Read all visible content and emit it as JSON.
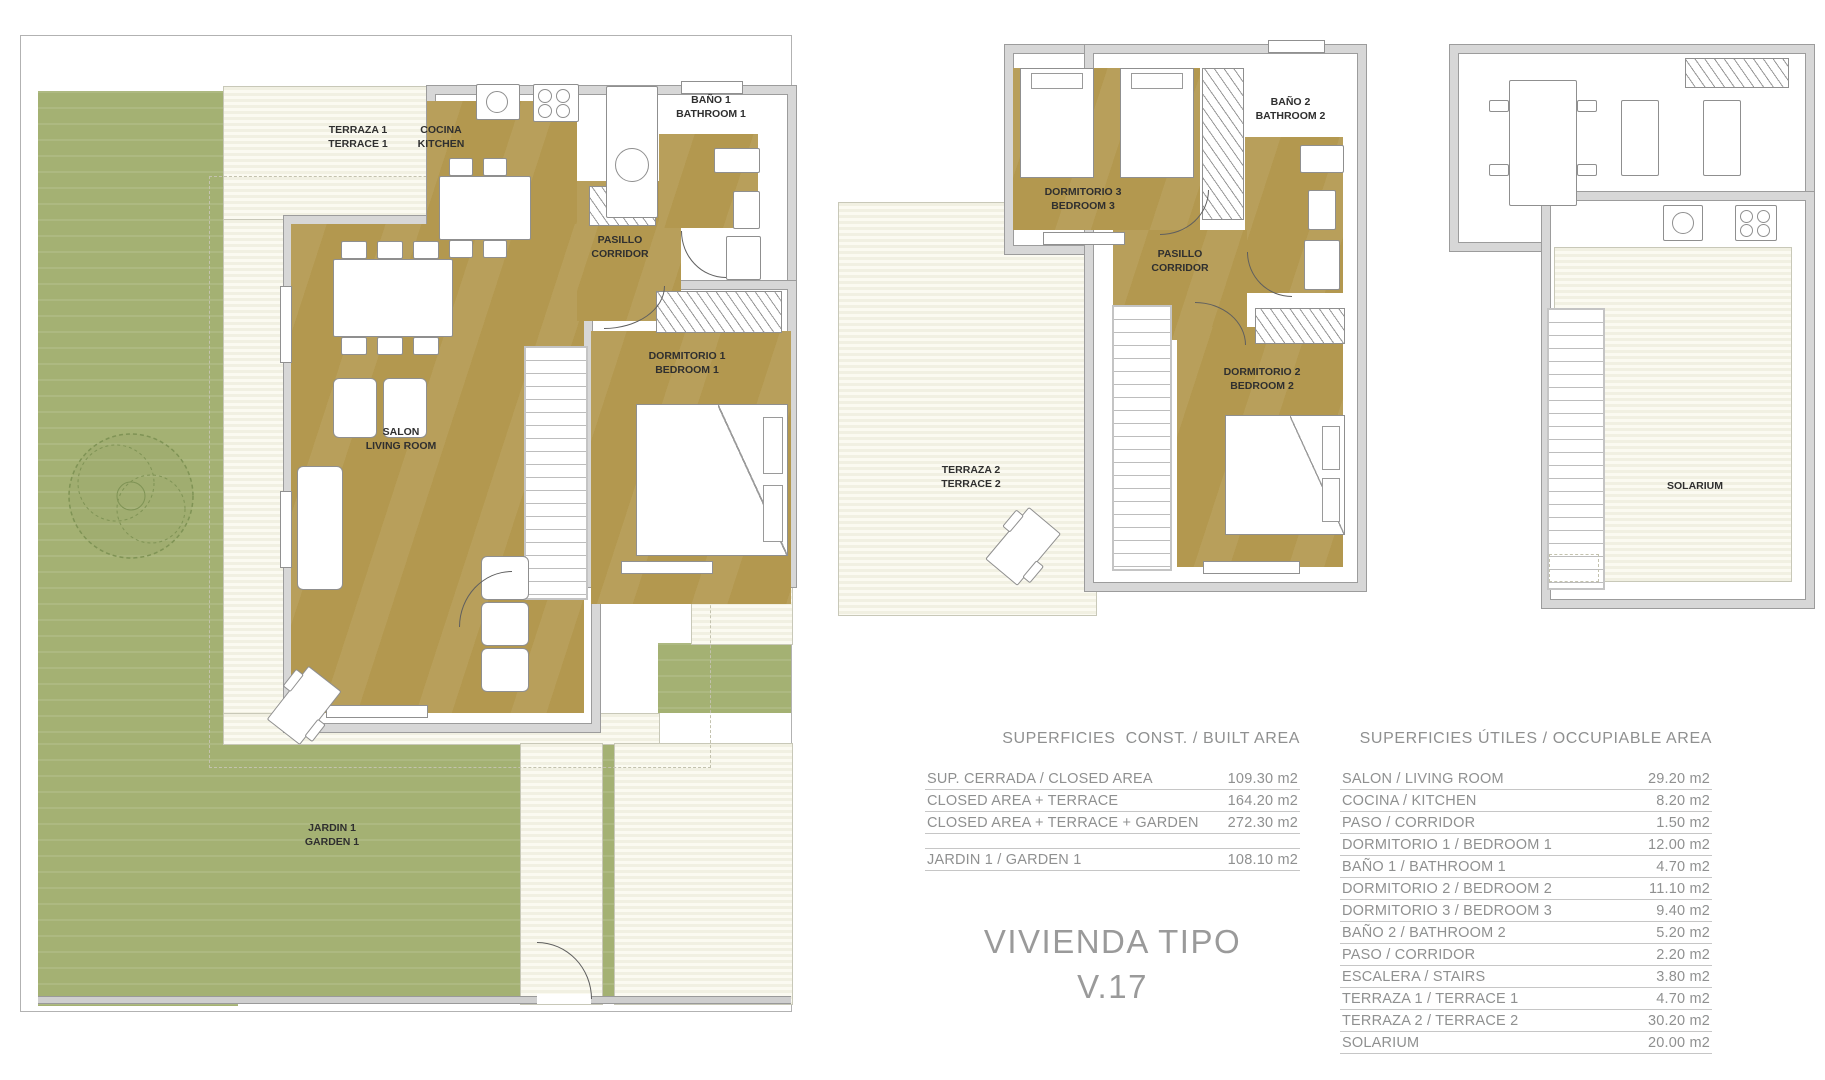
{
  "title": {
    "line1": "VIVIENDA TIPO",
    "line2": "V.17"
  },
  "ground_floor": {
    "terrace1": "TERRAZA 1\nTERRACE 1",
    "kitchen": "COCINA\nKITCHEN",
    "bathroom1": "BAÑO 1\nBATHROOM 1",
    "corridor": "PASILLO\nCORRIDOR",
    "bedroom1": "DORMITORIO 1\nBEDROOM 1",
    "living_room": "SALON\nLIVING ROOM",
    "garden": "JARDIN 1\nGARDEN 1"
  },
  "first_floor": {
    "bedroom3": "DORMITORIO 3\nBEDROOM 3",
    "bathroom2": "BAÑO 2\nBATHROOM 2",
    "corridor": "PASILLO\nCORRIDOR",
    "bedroom2": "DORMITORIO 2\nBEDROOM 2",
    "terrace2": "TERRAZA 2\nTERRACE 2"
  },
  "roof": {
    "solarium": "SOLARIUM"
  },
  "built_area_table": {
    "header": "SUPERFICIES  CONST. / BUILT AREA",
    "rows": [
      {
        "label": "SUP. CERRADA / CLOSED AREA",
        "value": "109.30 m2"
      },
      {
        "label": "CLOSED AREA + TERRACE",
        "value": "164.20 m2"
      },
      {
        "label": "CLOSED AREA + TERRACE + GARDEN",
        "value": "272.30 m2"
      }
    ],
    "garden_row": {
      "label": "JARDIN 1 / GARDEN 1",
      "value": "108.10 m2"
    }
  },
  "occupiable_area_table": {
    "header": "SUPERFICIES ÚTILES / OCCUPIABLE AREA",
    "rows": [
      {
        "label": "SALON / LIVING ROOM",
        "value": "29.20 m2"
      },
      {
        "label": "COCINA / KITCHEN",
        "value": "8.20 m2"
      },
      {
        "label": "PASO / CORRIDOR",
        "value": "1.50 m2"
      },
      {
        "label": "DORMITORIO 1 /  BEDROOM 1",
        "value": "12.00 m2"
      },
      {
        "label": "BAÑO 1 / BATHROOM 1",
        "value": "4.70 m2"
      },
      {
        "label": "DORMITORIO 2 / BEDROOM 2",
        "value": "11.10 m2"
      },
      {
        "label": "DORMITORIO 3 / BEDROOM 3",
        "value": "9.40 m2"
      },
      {
        "label": "BAÑO 2 / BATHROOM 2",
        "value": "5.20 m2"
      },
      {
        "label": "PASO / CORRIDOR",
        "value": "2.20 m2"
      },
      {
        "label": "ESCALERA / STAIRS",
        "value": "3.80 m2"
      },
      {
        "label": "TERRAZA 1 / TERRACE 1",
        "value": "4.70 m2"
      },
      {
        "label": "TERRAZA 2 / TERRACE 2",
        "value": "30.20 m2"
      },
      {
        "label": "SOLARIUM",
        "value": "20.00 m2"
      }
    ]
  },
  "colors": {
    "room_fill": "#b3984f",
    "garden_green": "#a4b173",
    "deck_cream": "#f1f0e2",
    "wall_gray": "#d7d7d7",
    "table_text": "#8f9090",
    "label_dark": "#2f2f2f",
    "title_gray": "#9a9a9a"
  }
}
